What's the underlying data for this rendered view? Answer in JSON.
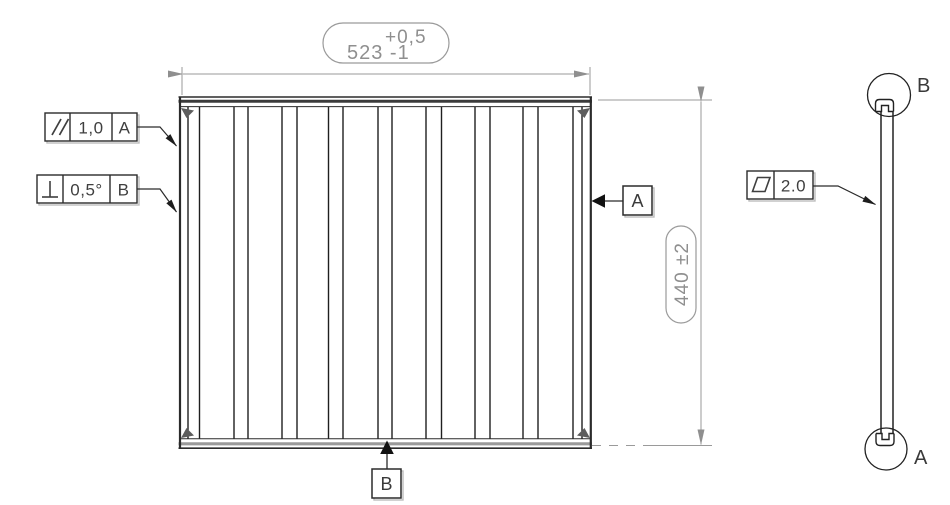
{
  "drawing": {
    "title": "panel-technical-drawing",
    "background_color": "#ffffff",
    "geometry_line_color": "#2b2b2b",
    "dimension_color": "#8f8f8f",
    "annotation_text_color": "#3f3f3f"
  },
  "main_view": {
    "width_dimension": {
      "tolerance_upper": "+0,5",
      "value_with_lower_tolerance": "523 -1"
    },
    "height_dimension": {
      "label": "440 ±2"
    },
    "fcf_parallelism": {
      "symbol": "parallelism-icon",
      "value": "1,0",
      "datum": "A"
    },
    "fcf_perpendicularity": {
      "symbol": "perpendicularity-icon",
      "value": "0,5°",
      "datum": "B"
    },
    "datum_a": {
      "label": "A"
    },
    "datum_b": {
      "label": "B"
    },
    "fin_lines_x": [
      188,
      199.5,
      234,
      248,
      282,
      297,
      328.5,
      343,
      378,
      392,
      426,
      441.5,
      475,
      490,
      523,
      538,
      573,
      582
    ]
  },
  "side_view": {
    "fcf_flatness": {
      "symbol": "flatness-icon",
      "value": "2.0"
    },
    "detail_circle_top": {
      "label": "B"
    },
    "detail_circle_bottom": {
      "label": "A"
    }
  }
}
